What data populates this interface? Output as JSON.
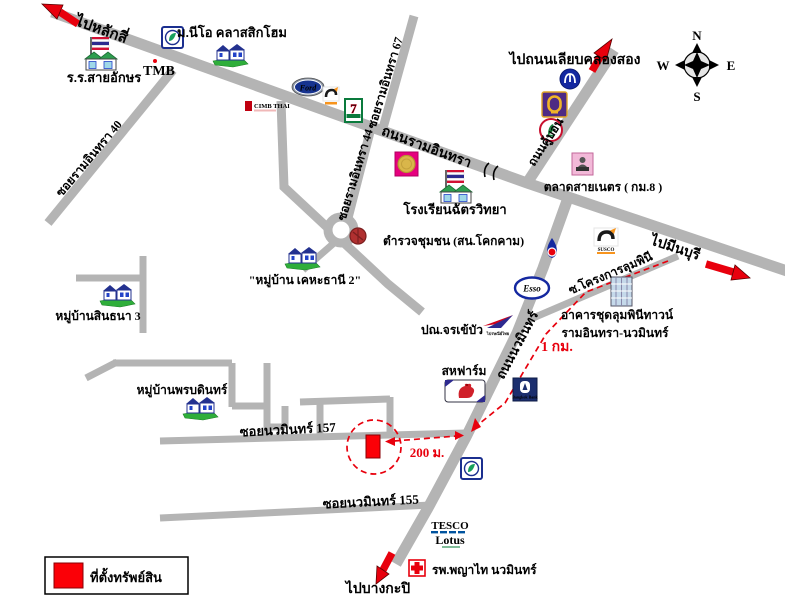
{
  "compass": {
    "n": "N",
    "e": "E",
    "s": "S",
    "w": "W"
  },
  "directions": {
    "lak_si": "ไปหลักสี่",
    "liab_khlong_song": "ไปถนนเลียบคลองสอง",
    "min_buri": "ไปมีนบุรี",
    "bang_kapi": "ไปบางกะปิ"
  },
  "roads": {
    "ram_inthra": "ถนนรามอินทรา",
    "khu_bon": "ถนนคู้บอน",
    "nawamin": "ถนนนวมินทร์",
    "soi_ram_inthra_40": "ซอยรามอินทรา 40",
    "soi_ram_inthra_44": "ซอยรามอินทรา 44",
    "soi_ram_inthra_67": "ซอยรามอินทรา 67",
    "soi_nawamin_157": "ซอยนวมินทร์ 157",
    "soi_nawamin_155": "ซอยนวมินทร์ 155",
    "soi_lumpini": "ซ.โครงการลุมพินี"
  },
  "places": {
    "sai_aksorn_school": "ร.ร.สายอักษร",
    "neo_classic_home": "ม.นีโอ คลาสสิกโฮม",
    "chat_witthaya_school": "โรงเรียนฉัตรวิทยา",
    "community_police": "ตำรวจชุมชน (สน.โคกคาม)",
    "khehathani2_village": "\"หมู่บ้าน เคหะธานี 2\"",
    "sinthana3_village": "หมู่บ้านสินธนา 3",
    "phonbodin_village": "หมู่บ้านพรบดินทร์",
    "sai_net_market": "ตลาดสายเนตร ( กม.8 )",
    "chorakhe_bua_post_office": "ปณ.จรเข้บัว",
    "saha_farm": "สหฟาร์ม",
    "lumpini_condo_line1": "อาคารชุดลุมพินีทาวน์",
    "lumpini_condo_line2": "รามอินทรา-นวมินทร์",
    "phyathai_hospital": "รพ.พญาไท นวมินทร์"
  },
  "logos": {
    "tmb": "TMB",
    "cimb": "CIMB THAI",
    "ford": "Ford",
    "susco": "SUSCO",
    "seven_eleven": "7",
    "esso": "Esso",
    "tesco": "TESCO",
    "lotus": "Lotus",
    "bangkok_bank": "Bangkok Bank",
    "thai_post": "ไปรษณีย์ไทย"
  },
  "distances": {
    "one_km": "1 กม.",
    "two_hundred_m": "200 ม."
  },
  "legend": {
    "property_location": "ที่ตั้งทรัพย์สิน"
  },
  "icons": [
    "compass-rose-icon",
    "red-direction-arrow-icon",
    "thai-flag-school-icon",
    "village-houses-icon",
    "bangchak-logo-icon",
    "tmb-logo-icon",
    "cimb-logo-icon",
    "ford-logo-icon",
    "susco-logo-icon",
    "seven-eleven-logo-icon",
    "gsb-bank-logo-icon",
    "blue-circle-bank-logo-icon",
    "scb-bank-logo-icon",
    "kasikorn-bank-logo-icon",
    "ptt-logo-icon",
    "esso-logo-icon",
    "thailand-post-logo-icon",
    "saha-farm-logo-icon",
    "bangkok-bank-logo-icon",
    "condo-building-icon",
    "market-icon",
    "police-spot-icon",
    "hospital-cross-icon",
    "tesco-lotus-logo-icon",
    "roundabout-icon",
    "railway-crossing-icon",
    "property-marker",
    "property-dashed-circle"
  ],
  "colors": {
    "road": "#b4b4b4",
    "accent_red": "#e8000d",
    "navy": "#1b2f8f",
    "green": "#2fae3a"
  }
}
